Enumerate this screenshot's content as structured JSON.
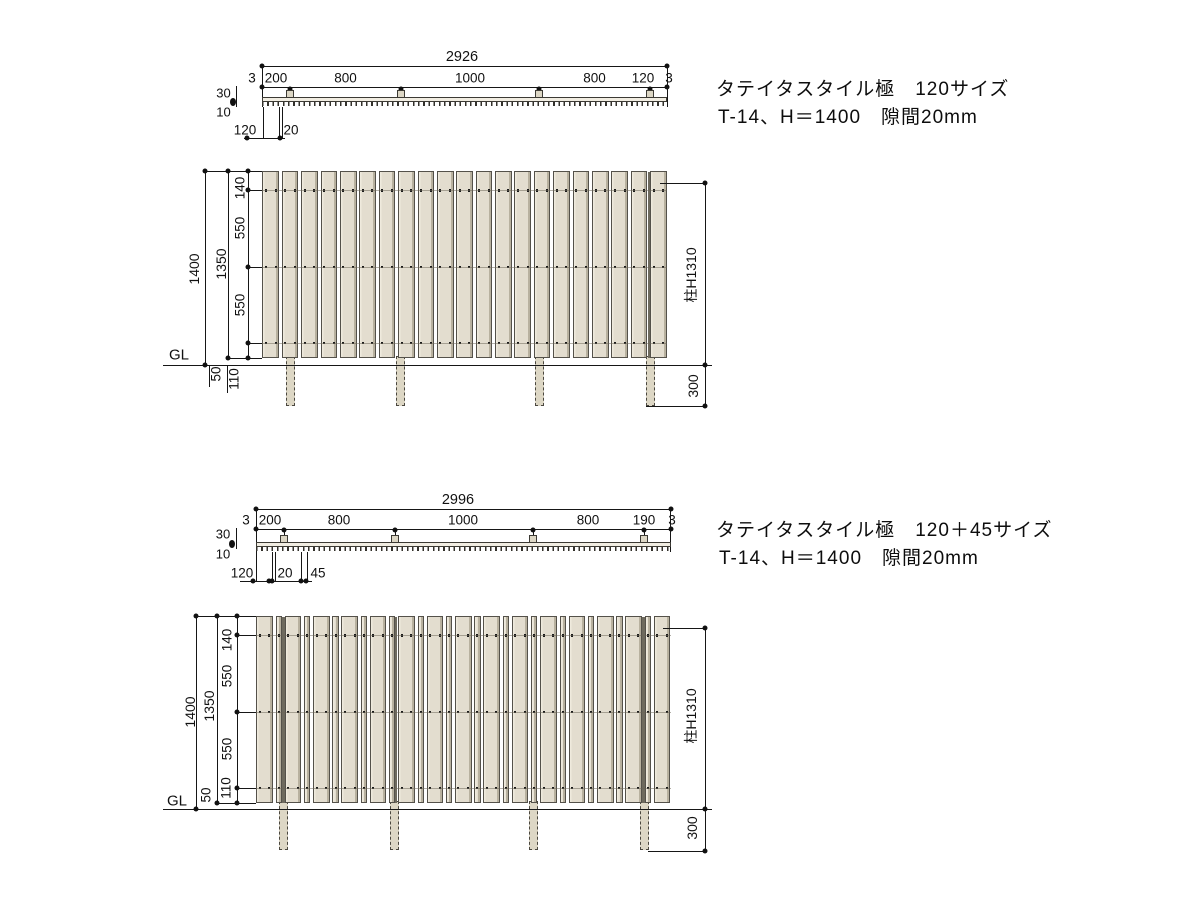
{
  "drawing_title": "タテイタスタイル フェンス図面",
  "sections": [
    {
      "title_line1": "タテイタスタイル極　120サイズ",
      "title_line2": "T-14、H＝1400　隙間20mm",
      "plan": {
        "overall": "2926",
        "segments": [
          "3",
          "200",
          "800",
          "1000",
          "800",
          "120",
          "3"
        ],
        "side_dims": {
          "rail": "30",
          "board": "10"
        },
        "detail_dims": [
          "120",
          "20"
        ]
      },
      "elevation": {
        "height_overall": "1400",
        "height_panel": "1350",
        "top_offset": "140",
        "spacing_upper": "550",
        "spacing_lower": "550",
        "bottom_offset": "110",
        "ground_clearance": "50",
        "ground_label": "GL",
        "post_height": "柱H1310",
        "embed_depth": "300"
      },
      "fence_spec": {
        "board_widths_mm": [
          120
        ],
        "board_count": 21,
        "gap_mm": 20,
        "edge_mm": 3,
        "total_mm": 2926,
        "post_offsets_mm": [
          203,
          1003,
          2003,
          2803
        ]
      }
    },
    {
      "title_line1": "タテイタスタイル極　120＋45サイズ",
      "title_line2": "T-14、H＝1400　隙間20mm",
      "plan": {
        "overall": "2996",
        "segments": [
          "3",
          "200",
          "800",
          "1000",
          "800",
          "190",
          "3"
        ],
        "side_dims": {
          "rail": "30",
          "board": "10"
        },
        "detail_dims": [
          "120",
          "20",
          "45"
        ]
      },
      "elevation": {
        "height_overall": "1400",
        "height_panel": "1350",
        "top_offset": "140",
        "spacing_upper": "550",
        "spacing_lower": "550",
        "bottom_offset": "110",
        "ground_clearance": "50",
        "ground_label": "GL",
        "post_height": "柱H1310",
        "embed_depth": "300"
      },
      "fence_spec": {
        "board_widths_mm": [
          120,
          45
        ],
        "board_count": 29,
        "gap_mm": 20,
        "edge_mm": 3,
        "total_mm": 2996,
        "post_offsets_mm": [
          203,
          1003,
          2003,
          2803
        ]
      }
    }
  ],
  "colors": {
    "background": "#ffffff",
    "line": "#161616",
    "board_fill": "#e3ddcf",
    "board_edge": "#54514a",
    "board_shade": "#b8b19f",
    "board_light": "#efeadd",
    "post_fill": "#ddd7c5",
    "post_edge": "#4a473f",
    "rail_fill": "#f1ede2",
    "rail_line": "#8d887b",
    "text": "#111111"
  }
}
